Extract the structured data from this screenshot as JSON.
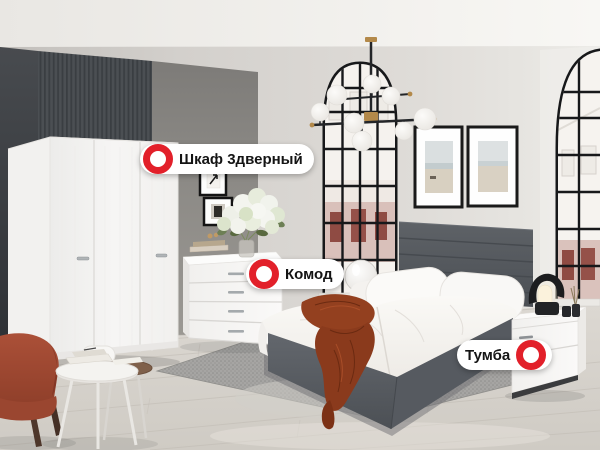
{
  "theme": {
    "hotspot_red": "#e2202a",
    "label_bg": "#ffffff",
    "label_text": "#141414"
  },
  "labels": {
    "wardrobe": {
      "text": "Шкаф 3дверный",
      "icon": "hotspot-ring-icon",
      "icon_side": "left"
    },
    "dresser": {
      "text": "Комод",
      "icon": "hotspot-ring-icon",
      "icon_side": "left"
    },
    "nightstand": {
      "text": "Тумба",
      "icon": "hotspot-ring-icon",
      "icon_side": "right"
    }
  }
}
